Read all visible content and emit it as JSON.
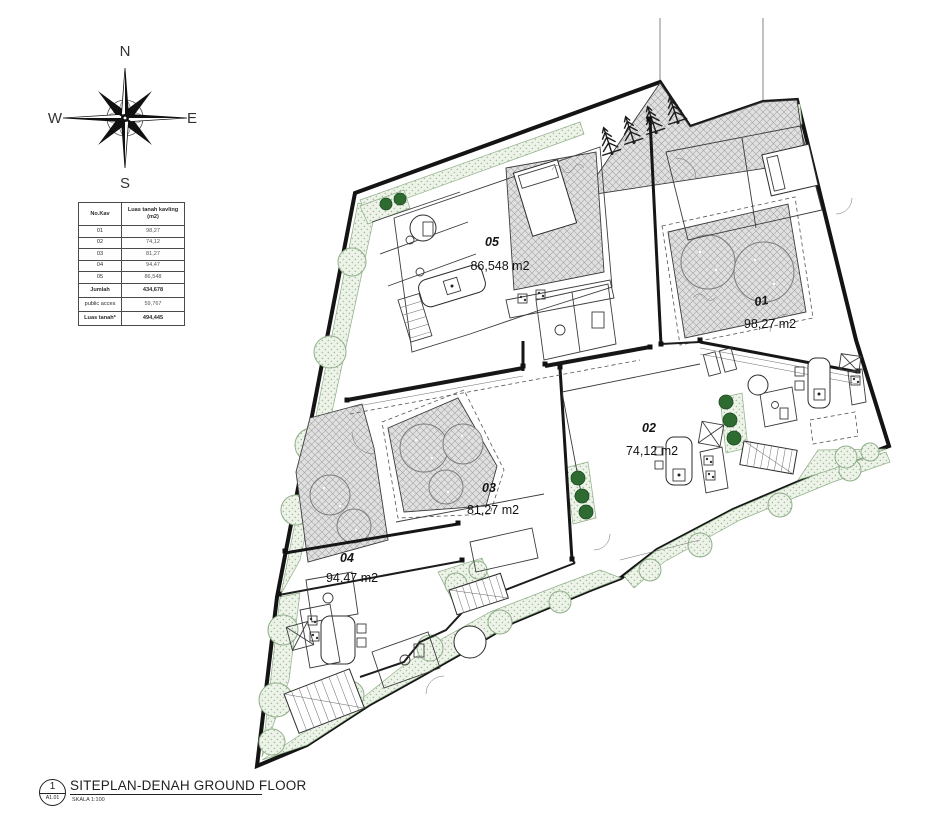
{
  "compass": {
    "n": "N",
    "e": "E",
    "s": "S",
    "w": "W"
  },
  "kavling_table": {
    "header": {
      "col1": "No.Kav",
      "col2_line1": "Luas tanah kavling",
      "col2_line2": "(m2)"
    },
    "rows": [
      [
        "01",
        "98,27"
      ],
      [
        "02",
        "74,12"
      ],
      [
        "03",
        "81,27"
      ],
      [
        "04",
        "94,47"
      ],
      [
        "05",
        "86,548"
      ]
    ],
    "summary": [
      [
        "Jumlah",
        "434,678"
      ],
      [
        "public acces",
        "59,767"
      ],
      [
        "Luas tanah*",
        "494,445"
      ]
    ]
  },
  "plan": {
    "units": [
      {
        "id": "01",
        "area": "98,27 m2"
      },
      {
        "id": "02",
        "area": "74,12 m2"
      },
      {
        "id": "03",
        "area": "81,27 m2"
      },
      {
        "id": "04",
        "area": "94,47 m2"
      },
      {
        "id": "05",
        "area": "86,548 m2"
      }
    ]
  },
  "titleblock": {
    "number": "1",
    "sheet": "A1.01",
    "title": "SITEPLAN-DENAH GROUND FLOOR",
    "scale": "SKALA 1:100"
  },
  "colors": {
    "line": "#1a1a1a",
    "landscape_green": "#8fae88",
    "deck_gray": "#dedede",
    "bush_green": "#2e6b31"
  }
}
